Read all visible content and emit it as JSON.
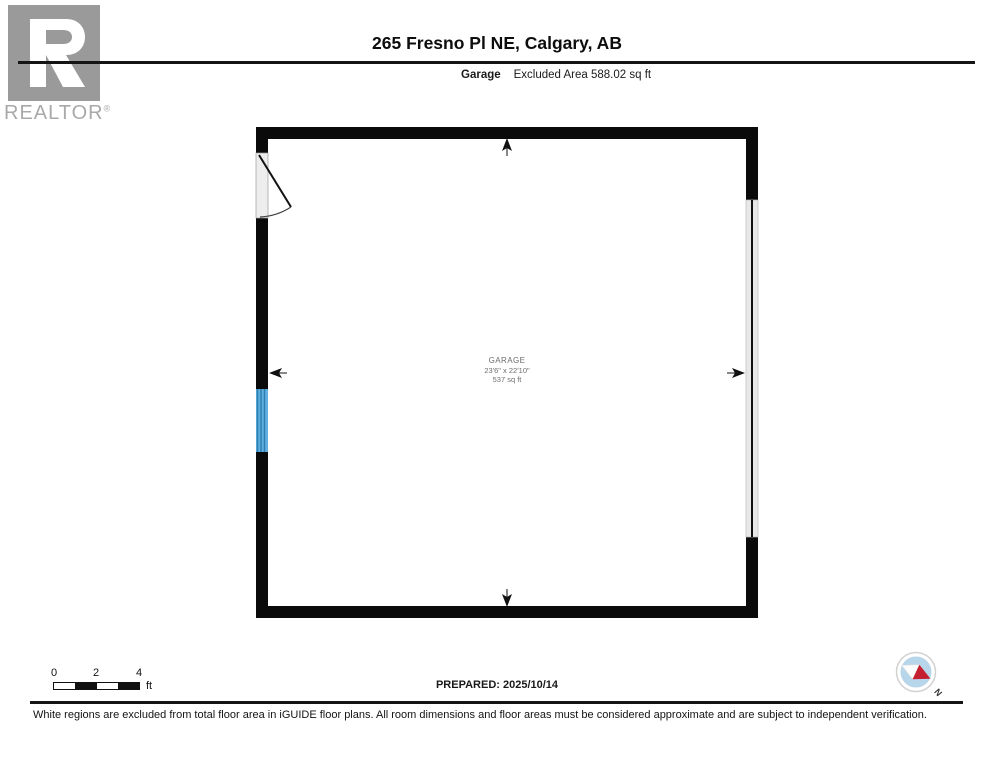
{
  "header": {
    "title": "265 Fresno Pl NE, Calgary, AB",
    "room_type": "Garage",
    "excluded_area": "Excluded Area 588.02 sq ft"
  },
  "logo": {
    "brand": "REALTOR",
    "registered": "®"
  },
  "floorplan": {
    "room": {
      "name": "GARAGE",
      "dimensions": "23'6\" x 22'10\"",
      "area": "537 sq ft"
    }
  },
  "scalebar": {
    "ticks": [
      "0",
      "2",
      "4"
    ],
    "unit": "ft"
  },
  "compass": {
    "north_label": "N"
  },
  "footer": {
    "prepared": "PREPARED: 2025/10/14",
    "disclaimer": "White regions are excluded from total floor area in iGUIDE floor plans. All room dimensions and floor areas must be considered approximate and are subject to independent verification."
  },
  "colors": {
    "wall": "#0a0a0a",
    "door_fill": "#ededed",
    "window_blue": "#5fb0e0",
    "window_frame": "#2e7fb0",
    "garage_door_fill": "#e8e8e8",
    "compass_blue": "#b7d6ea",
    "needle_red": "#c42030",
    "logo_gray": "#9a9a9a"
  }
}
